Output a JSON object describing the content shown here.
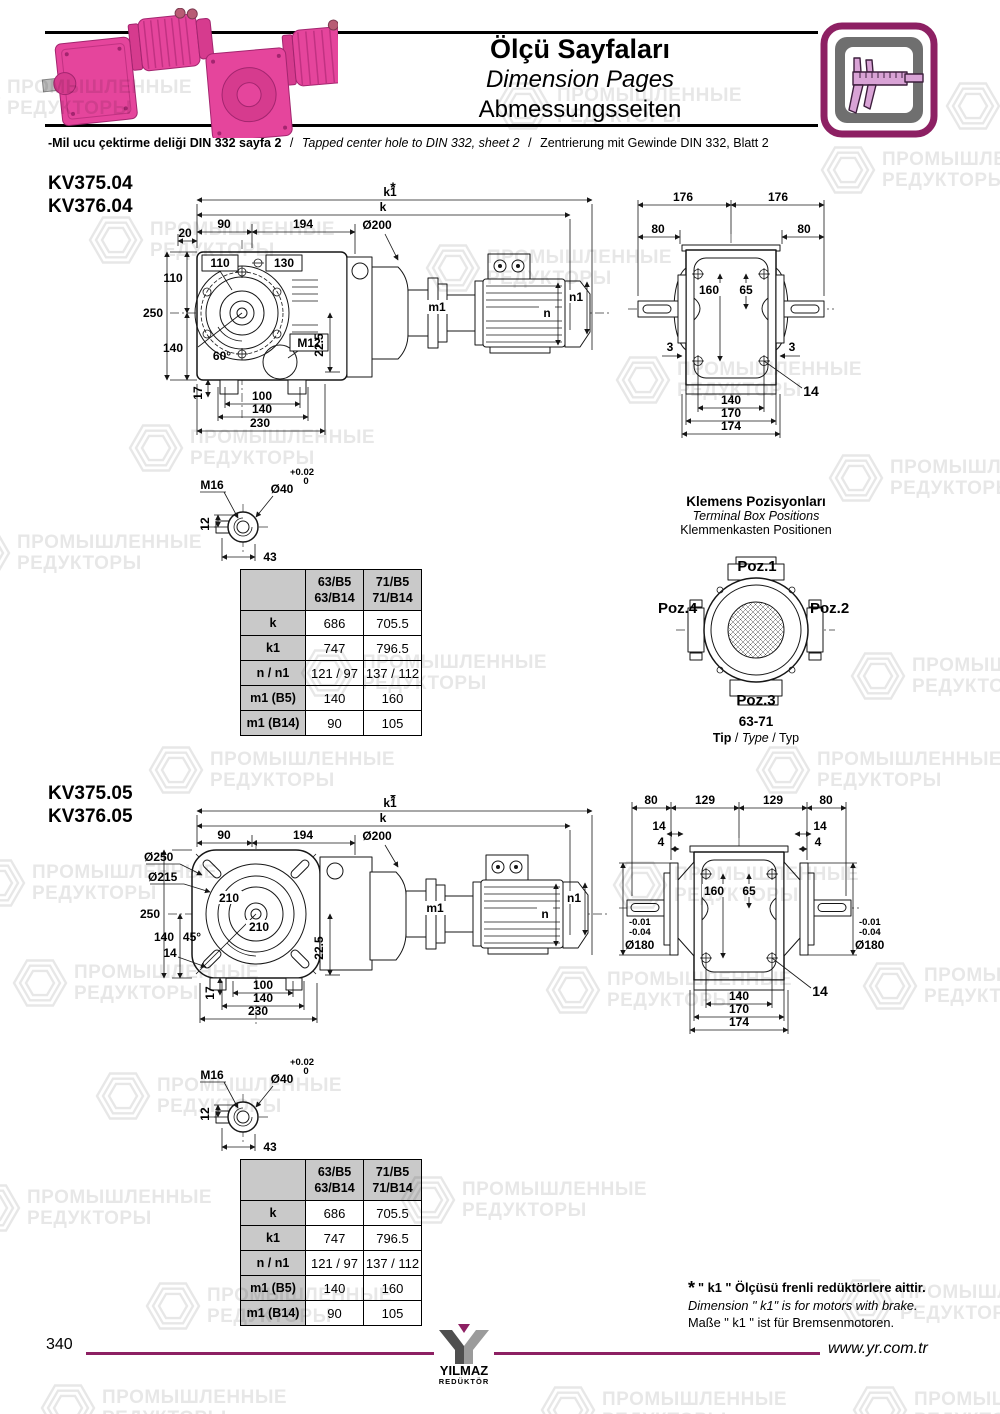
{
  "header": {
    "title_tr": "Ölçü Sayfaları",
    "title_en": "Dimension Pages",
    "title_de": "Abmessungsseiten",
    "sep": "/",
    "note_tr": "-Mil ucu çektirme deliği DIN 332 sayfa 2",
    "note_en": "Tapped center hole to DIN 332, sheet 2",
    "note_de": "Zentrierung mit Gewinde DIN 332, Blatt 2"
  },
  "wm": {
    "l1": "ПРОМЫШЛЕННЫЕ",
    "l2": "РЕДУКТОРЫ"
  },
  "s1": {
    "model1": "KV375.04",
    "model2": "KV376.04",
    "front": {
      "star": "*",
      "k1": "k1",
      "k": "k",
      "d90": "90",
      "d194": "194",
      "dia200": "Ø200",
      "d20": "20",
      "d110": "110",
      "d250": "250",
      "d140": "140",
      "b110": "110",
      "b130": "130",
      "m12": "M12",
      "a60": "60°",
      "d225": "22.5",
      "d17": "17",
      "d100": "100",
      "d140b": "140",
      "d230": "230",
      "m1": "m1",
      "n": "n",
      "n1": "n1"
    },
    "side": {
      "t176a": "176",
      "t176b": "176",
      "t80a": "80",
      "t80b": "80",
      "d160": "160",
      "d65": "65",
      "d3a": "3",
      "d3b": "3",
      "d14": "14",
      "b140": "140",
      "b170": "170",
      "b174": "174"
    }
  },
  "s2": {
    "model1": "KV375.05",
    "model2": "KV376.05",
    "front": {
      "star": "*",
      "k1": "k1",
      "k": "k",
      "d90": "90",
      "d194": "194",
      "dia200": "Ø200",
      "dia250": "Ø250",
      "dia215": "Ø215",
      "d210a": "210",
      "d210b": "210",
      "d250": "250",
      "d140": "140",
      "a45": "45°",
      "d14": "14",
      "d225": "22.5",
      "d17": "17",
      "d100": "100",
      "d140b": "140",
      "d230": "230",
      "m1": "m1",
      "n": "n",
      "n1": "n1"
    },
    "side": {
      "t80a": "80",
      "t129a": "129",
      "t129b": "129",
      "t80b": "80",
      "s14a": "14",
      "s4a": "4",
      "s14b": "14",
      "s4b": "4",
      "d160": "160",
      "d65": "65",
      "tolA1": "-0.01",
      "tolA2": "-0.04",
      "diaA": "Ø180",
      "tolB1": "-0.01",
      "tolB2": "-0.04",
      "diaB": "Ø180",
      "d14": "14",
      "b140": "140",
      "b170": "170",
      "b174": "174"
    }
  },
  "shaft": {
    "m16": "M16",
    "dia40": "Ø40",
    "tol1": "+0.02",
    "tol2": "0",
    "d12": "12",
    "d43": "43"
  },
  "table": {
    "h1a": "63/B5",
    "h1b": "63/B14",
    "h2a": "71/B5",
    "h2b": "71/B14",
    "rows": [
      {
        "label": "k",
        "v1": "686",
        "v2": "705.5"
      },
      {
        "label": "k1",
        "v1": "747",
        "v2": "796.5"
      },
      {
        "label": "n / n1",
        "v1": "121 / 97",
        "v2": "137 / 112"
      },
      {
        "label": "m1 (B5)",
        "v1": "140",
        "v2": "160"
      },
      {
        "label": "m1 (B14)",
        "v1": "90",
        "v2": "105"
      }
    ]
  },
  "terminal": {
    "t_tr": "Klemens Pozisyonları",
    "t_en": "Terminal Box Positions",
    "t_de": "Klemmenkasten Positionen",
    "poz1": "Poz.1",
    "poz2": "Poz.2",
    "poz3": "Poz.3",
    "poz4": "Poz.4",
    "size": "63-71",
    "tip_tr": "Tip",
    "tip_en": "Type",
    "tip_de": "Typ",
    "sep": "/"
  },
  "footnote": {
    "star": "*",
    "l_tr": "\" k1 \" Ölçüsü frenli redüktörlere aittir.",
    "l_en": "Dimension \" k1\" is for motors with brake.",
    "l_de": "Maße \" k1 \" ist für Bremsenmotoren."
  },
  "footer": {
    "page": "340",
    "url": "www.yr.com.tr",
    "brand1": "YILMAZ",
    "brand2": "REDÜKTÖR"
  },
  "colors": {
    "accent": "#8d2063",
    "pink": "#e5459c",
    "gray_cell": "#c9c9c9"
  }
}
